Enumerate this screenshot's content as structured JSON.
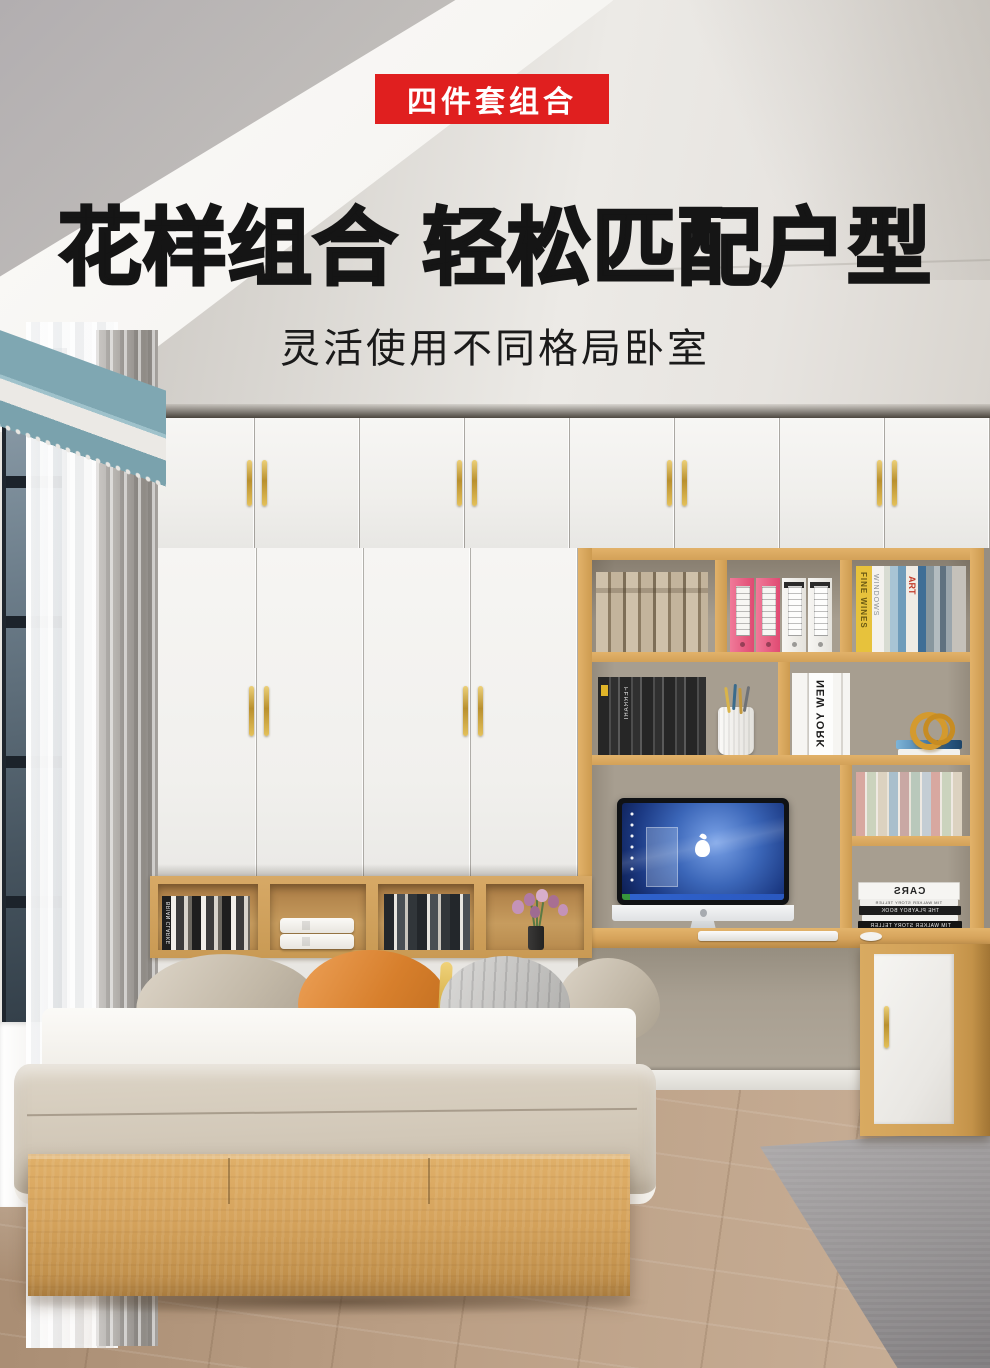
{
  "header": {
    "badge": "四件套组合",
    "title": "花样组合 轻松匹配户型",
    "subtitle": "灵活使用不同格局卧室"
  },
  "books": {
    "brian_clarke": "BRIAN CLARKE",
    "ferrari": "FERRARI",
    "new_york": "NEW YORK",
    "fine_wines": "FINE WINES",
    "windows": "WINDOWS",
    "art": "ART",
    "cars": "CARS",
    "tim_walker": "TIM WALKER STORY TELLER",
    "playboy_book": "THE PLAYBOY BOOK"
  },
  "colors": {
    "accent_red": "#e01f1f",
    "title_text": "#151515",
    "wood": "#d6a45d",
    "wall_taupe": "#a89f91",
    "floor_wood": "#b89c82",
    "curtain_teal": "#7fa7b2",
    "rug_gray": "#969394",
    "pillow_orange": "#d77f2c"
  }
}
